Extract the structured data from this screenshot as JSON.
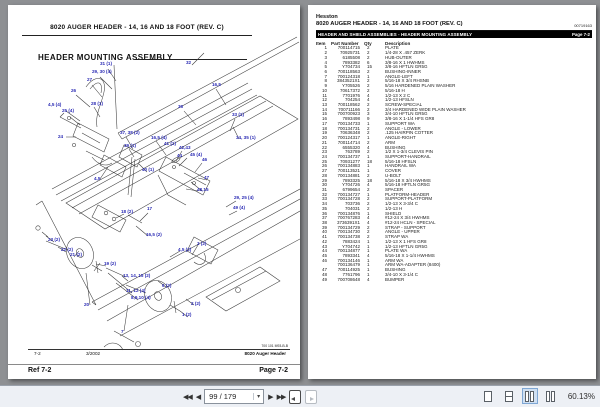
{
  "left_page": {
    "header_title": "8020 AUGER HEADER - 14, 16 AND 18 FOOT (REV. C)",
    "section_title": "HEADER MOUNTING ASSEMBLY",
    "footer": {
      "doc_code": "700 101 M93-B-B",
      "ref": "7-2",
      "date": "3/2002",
      "doc_title": "8020 Auger Header"
    },
    "refbar": {
      "ref": "Ref 7-2",
      "page": "Page 7-2"
    },
    "diagram": {
      "callout_color": "#2b2bb4",
      "callouts": [
        {
          "label": "31 (1)",
          "x": 92,
          "y": 56
        },
        {
          "label": "29, 30 (4)",
          "x": 84,
          "y": 64
        },
        {
          "label": "27",
          "x": 79,
          "y": 72
        },
        {
          "label": "26",
          "x": 63,
          "y": 83
        },
        {
          "label": "4,5 (4)",
          "x": 40,
          "y": 97
        },
        {
          "label": "28 (1)",
          "x": 83,
          "y": 96
        },
        {
          "label": "25 (4)",
          "x": 54,
          "y": 103
        },
        {
          "label": "24",
          "x": 50,
          "y": 129
        },
        {
          "label": "37, 38 (2)",
          "x": 112,
          "y": 125
        },
        {
          "label": "39 (1)",
          "x": 116,
          "y": 138
        },
        {
          "label": "16,5 (4)",
          "x": 143,
          "y": 130
        },
        {
          "label": "41 (1)",
          "x": 156,
          "y": 136
        },
        {
          "label": "40 (1)",
          "x": 134,
          "y": 162
        },
        {
          "label": "4,5",
          "x": 86,
          "y": 171
        },
        {
          "label": "32",
          "x": 178,
          "y": 55
        },
        {
          "label": "16,5",
          "x": 204,
          "y": 77
        },
        {
          "label": "36",
          "x": 170,
          "y": 99
        },
        {
          "label": "33 (1)",
          "x": 224,
          "y": 107
        },
        {
          "label": "34, 35 (1)",
          "x": 228,
          "y": 130
        },
        {
          "label": "42,43",
          "x": 171,
          "y": 140
        },
        {
          "label": "44",
          "x": 169,
          "y": 148
        },
        {
          "label": "45 (4)",
          "x": 182,
          "y": 147
        },
        {
          "label": "46",
          "x": 194,
          "y": 152
        },
        {
          "label": "47",
          "x": 196,
          "y": 170
        },
        {
          "label": "48,15",
          "x": 189,
          "y": 182
        },
        {
          "label": "29, 25 (4)",
          "x": 226,
          "y": 190
        },
        {
          "label": "49 (4)",
          "x": 225,
          "y": 200
        },
        {
          "label": "18 (2)",
          "x": 113,
          "y": 204
        },
        {
          "label": "17",
          "x": 139,
          "y": 201
        },
        {
          "label": "16,5 (2)",
          "x": 138,
          "y": 227
        },
        {
          "label": "23 (2)",
          "x": 40,
          "y": 232
        },
        {
          "label": "22 (2)",
          "x": 53,
          "y": 242
        },
        {
          "label": "21 (2)",
          "x": 62,
          "y": 247
        },
        {
          "label": "19 (2)",
          "x": 96,
          "y": 256
        },
        {
          "label": "13, 14, 15 (2)",
          "x": 115,
          "y": 268
        },
        {
          "label": "11, 12 (4)",
          "x": 118,
          "y": 283
        },
        {
          "label": "8,9,10 (4)",
          "x": 123,
          "y": 290
        },
        {
          "label": "20",
          "x": 76,
          "y": 297
        },
        {
          "label": "7",
          "x": 113,
          "y": 324
        },
        {
          "label": "4,5 (2)",
          "x": 170,
          "y": 242
        },
        {
          "label": "3 (2)",
          "x": 189,
          "y": 236
        },
        {
          "label": "6 (2)",
          "x": 154,
          "y": 278
        },
        {
          "label": "2 (2)",
          "x": 183,
          "y": 296
        },
        {
          "label": "1 (2)",
          "x": 174,
          "y": 307
        }
      ]
    }
  },
  "right_page": {
    "brand": "Hesston",
    "title": "8020 AUGER HEADER - 14, 16 AND 18 FOOT (REV. C)",
    "doc_number": "00719163",
    "section_bar": "HEADER AND SHIELD ASSEMBLIES - HEADER MOUNTING ASSEMBLY",
    "section_page": "Page 7-2",
    "table": {
      "headers": [
        "Item",
        "Part Number",
        "Qty",
        "Description"
      ],
      "rows": [
        [
          "1",
          "700114715",
          "2",
          "PLATE"
        ],
        [
          "2",
          "70925731",
          "2",
          "1/4-28 X .457 ZERK"
        ],
        [
          "3",
          "6185508",
          "2",
          "HUB-OUTER"
        ],
        [
          "4",
          "7893382",
          "6",
          "3/8-16 X 1 HWHMS"
        ],
        [
          "5",
          "Y704734",
          "15",
          "3/8-16 HFTLN GR5G"
        ],
        [
          "6",
          "700118563",
          "2",
          "BUSHING-INNER"
        ],
        [
          "7",
          "700124318",
          "1",
          "ANGLE-LEFT"
        ],
        [
          "8",
          "3843521X1",
          "2",
          "5/16-18 X 3/4 RHSNB"
        ],
        [
          "9",
          "Y705526",
          "2",
          "5/16 HARDENED PLAIN WASHER"
        ],
        [
          "10",
          "70617372",
          "2",
          "5/16-18 H"
        ],
        [
          "11",
          "7701976",
          "4",
          "1/2-13 X 2 C"
        ],
        [
          "12",
          "704254",
          "4",
          "1/2-13 HFSLN"
        ],
        [
          "13",
          "700118562",
          "2",
          "SCREW-SPECIAL"
        ],
        [
          "14",
          "700711166",
          "2",
          "3/4 HARDENED WIDE PLAIN WASHER"
        ],
        [
          "15",
          "700700923",
          "3",
          "3/4-10 HFTLN GR5G"
        ],
        [
          "16",
          "7893498",
          "9",
          "3/8-16 X 1-1/4 HFS GR8"
        ],
        [
          "17",
          "700134733",
          "1",
          "SUPPORT WA"
        ],
        [
          "18",
          "700134731",
          "2",
          "ANGLE - LOWER"
        ],
        [
          "19",
          "70636348",
          "2",
          ".125 HAIRPIN COTTER"
        ],
        [
          "20",
          "700124317",
          "1",
          "ANGLE-RIGHT"
        ],
        [
          "21",
          "700114714",
          "2",
          "ARM"
        ],
        [
          "22",
          "6555320",
          "4",
          "BUSHING"
        ],
        [
          "23",
          "763789",
          "2",
          "1/2 X 1-3/4 CLEVIS PIN"
        ],
        [
          "24",
          "700134737",
          "1",
          "SUPPORT-HANDRAIL"
        ],
        [
          "25",
          "70931277",
          "18",
          "5/16-18 HFSLN"
        ],
        [
          "26",
          "700134883",
          "1",
          "HANDRAIL WA"
        ],
        [
          "27",
          "700113521",
          "1",
          "COVER"
        ],
        [
          "28",
          "700134881",
          "2",
          "U-BOLT"
        ],
        [
          "29",
          "7893325",
          "18",
          "5/16-18 X 3/4 HWHMS"
        ],
        [
          "30",
          "Y704726",
          "4",
          "5/16-18 HFTLN GR5G"
        ],
        [
          "31",
          "6799654",
          "2",
          "SPACER"
        ],
        [
          "32",
          "700134727",
          "1",
          "PLATFORM-HEADER"
        ],
        [
          "33",
          "700134728",
          "2",
          "SUPPORT-PLATFORM"
        ],
        [
          "34",
          "703736",
          "2",
          "1/2-13 X 3-3/4 C"
        ],
        [
          "35",
          "704031",
          "2",
          "1/2-13 H"
        ],
        [
          "36",
          "700134876",
          "1",
          "SHIELD"
        ],
        [
          "37",
          "700767283",
          "4",
          "#12-24 X 3/4 HWHMS"
        ],
        [
          "38",
          "3736391X1",
          "4",
          "#12-24 HCLN - SPECIAL"
        ],
        [
          "39",
          "700134729",
          "2",
          "STRAP - SUPPORT"
        ],
        [
          "40",
          "700134730",
          "2",
          "ANGLE - UPPER"
        ],
        [
          "41",
          "700134738",
          "2",
          "STRAP WA"
        ],
        [
          "42",
          "7883424",
          "1",
          "1/2-13 X 1 HFS GR8"
        ],
        [
          "43",
          "Y704742",
          "1",
          "1/2-13 HFTLN GR5G"
        ],
        [
          "44",
          "700134877",
          "1",
          "PLATE WA"
        ],
        [
          "45",
          "7893341",
          "4",
          "5/16-18 X 1-1/4 HWHMS"
        ],
        [
          "46",
          "700134146",
          "1",
          "ARM WA"
        ],
        [
          "",
          "700136479",
          "1",
          "ARM WA-ADAPTER (8400)"
        ],
        [
          "47",
          "700114925",
          "1",
          "BUSHING"
        ],
        [
          "48",
          "7761796",
          "1",
          "3/4-10 X 3-1/4 C"
        ],
        [
          "49",
          "700708648",
          "4",
          "BUMPER"
        ]
      ]
    }
  },
  "toolbar": {
    "page_indicator": "99 / 179",
    "zoom_level": "60.13%",
    "selected_view": "two-page",
    "icons": {
      "first_page": "◀◀",
      "previous_page": "◀",
      "next_page": "▶",
      "last_page": "▶▶",
      "dropdown": "▾"
    }
  }
}
